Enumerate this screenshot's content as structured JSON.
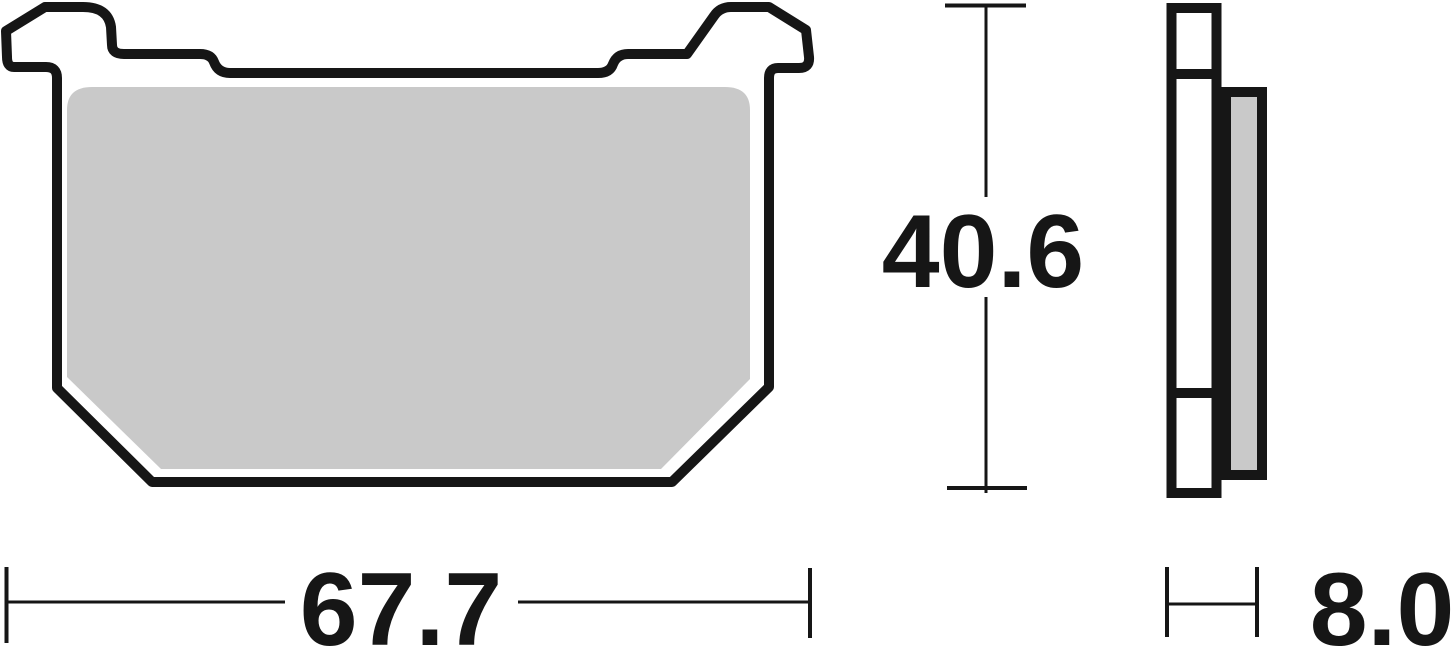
{
  "drawing": {
    "type": "technical-drawing",
    "subject": "brake-pad",
    "views": [
      "front-profile",
      "side-profile"
    ]
  },
  "dimensions": {
    "width": "67.7",
    "height": "40.6",
    "thickness": "8.0"
  },
  "colors": {
    "line": "#161616",
    "friction_pad_fill": "#c9c9c9",
    "backplate_fill": "#ffffff",
    "background": "#ffffff"
  }
}
